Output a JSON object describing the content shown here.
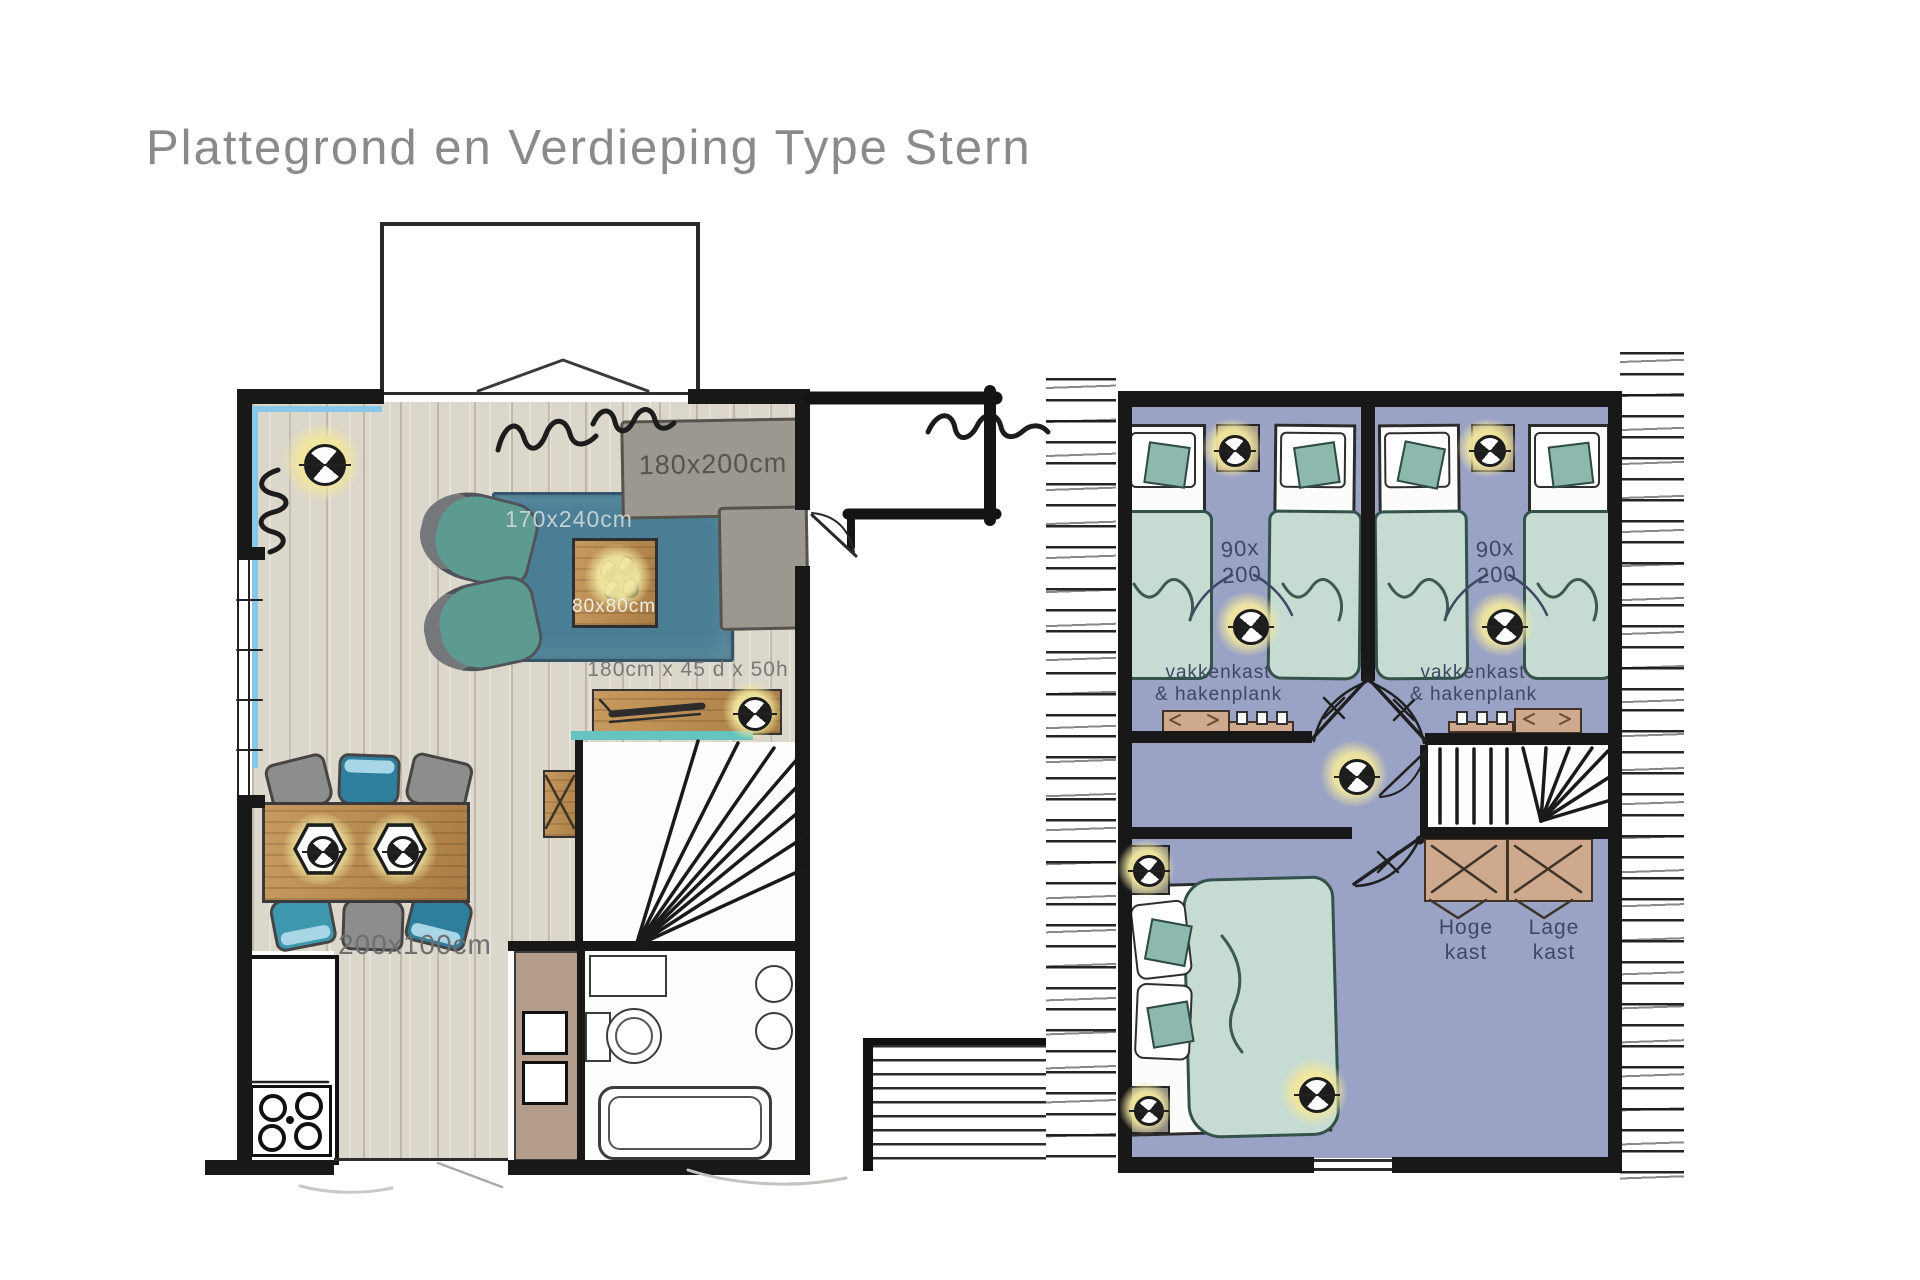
{
  "title": "Plattegrond en Verdieping Type Stern",
  "ground_floor": {
    "sofa_label": "180x200cm",
    "rug_label": "170x240cm",
    "coffee_table_label": "80x80cm",
    "sideboard_label": "180cm x 45 d x 50h",
    "dining_table_label": "200x100cm"
  },
  "upper_floor": {
    "bed_width": "90x",
    "bed_length": "200",
    "closet_line1": "vakkenkast",
    "closet_line2": "& hakenplank",
    "high_cabinet_line1": "Hoge",
    "high_cabinet_line2": "kast",
    "low_cabinet_line1": "Lage",
    "low_cabinet_line2": "kast"
  },
  "colors": {
    "wall": "#181818",
    "wood_floor": "#dcd7cb",
    "rug_blue": "#4a7e95",
    "sofa_gray": "#9c978f",
    "armchair_teal": "#5d9a8f",
    "table_wood": "#b0854f",
    "upper_floor_lavender": "#9aa2c5",
    "bed_green": "#c6dcd3",
    "cushion_teal": "#8cb8ad",
    "cabinet_brown": "#cfa98e",
    "lamp_glow": "#f0e79e",
    "window_blue": "#87c7e7",
    "title_gray": "#8a8a8a",
    "label_blue_gray": "#3f4862"
  }
}
